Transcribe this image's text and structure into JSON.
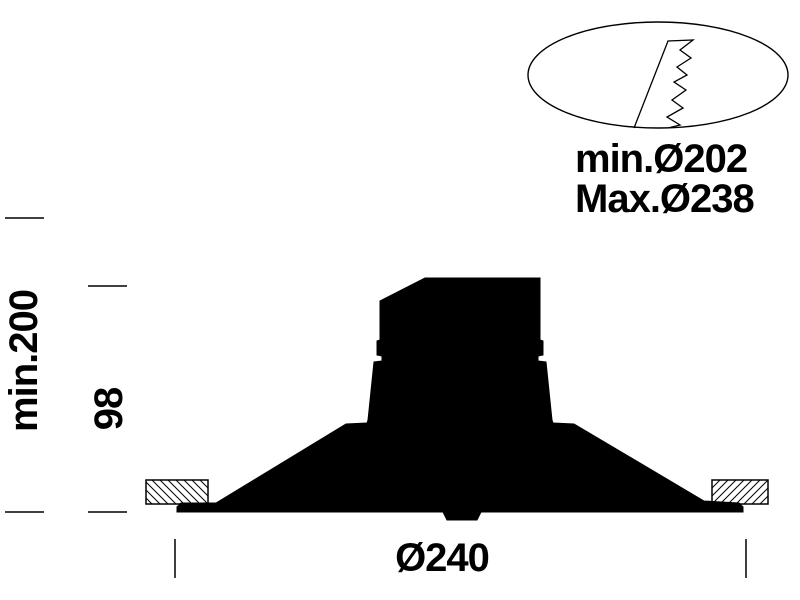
{
  "page": {
    "background_color": "#ffffff",
    "ink_color": "#000000",
    "description": "Technical installation drawing of a recessed downlight fixture, side cross-section"
  },
  "detail_callout": {
    "cutout_min_label": "min.Ø202",
    "cutout_max_label": "Max.Ø238"
  },
  "dimensions": {
    "recess_depth_label": "min.200",
    "fixture_height_label": "98",
    "flange_diameter_label": "Ø240"
  },
  "shapes": {
    "fixture_silhouette": "black cross-section silhouette of downlight body with flange",
    "ceiling_section_left": "hatched ceiling cut rectangle (backslash hatch)",
    "ceiling_section_right": "hatched ceiling cut rectangle (slash hatch)",
    "spring_clip_detail": "ellipse callout containing serrated spring-clip zigzag"
  }
}
